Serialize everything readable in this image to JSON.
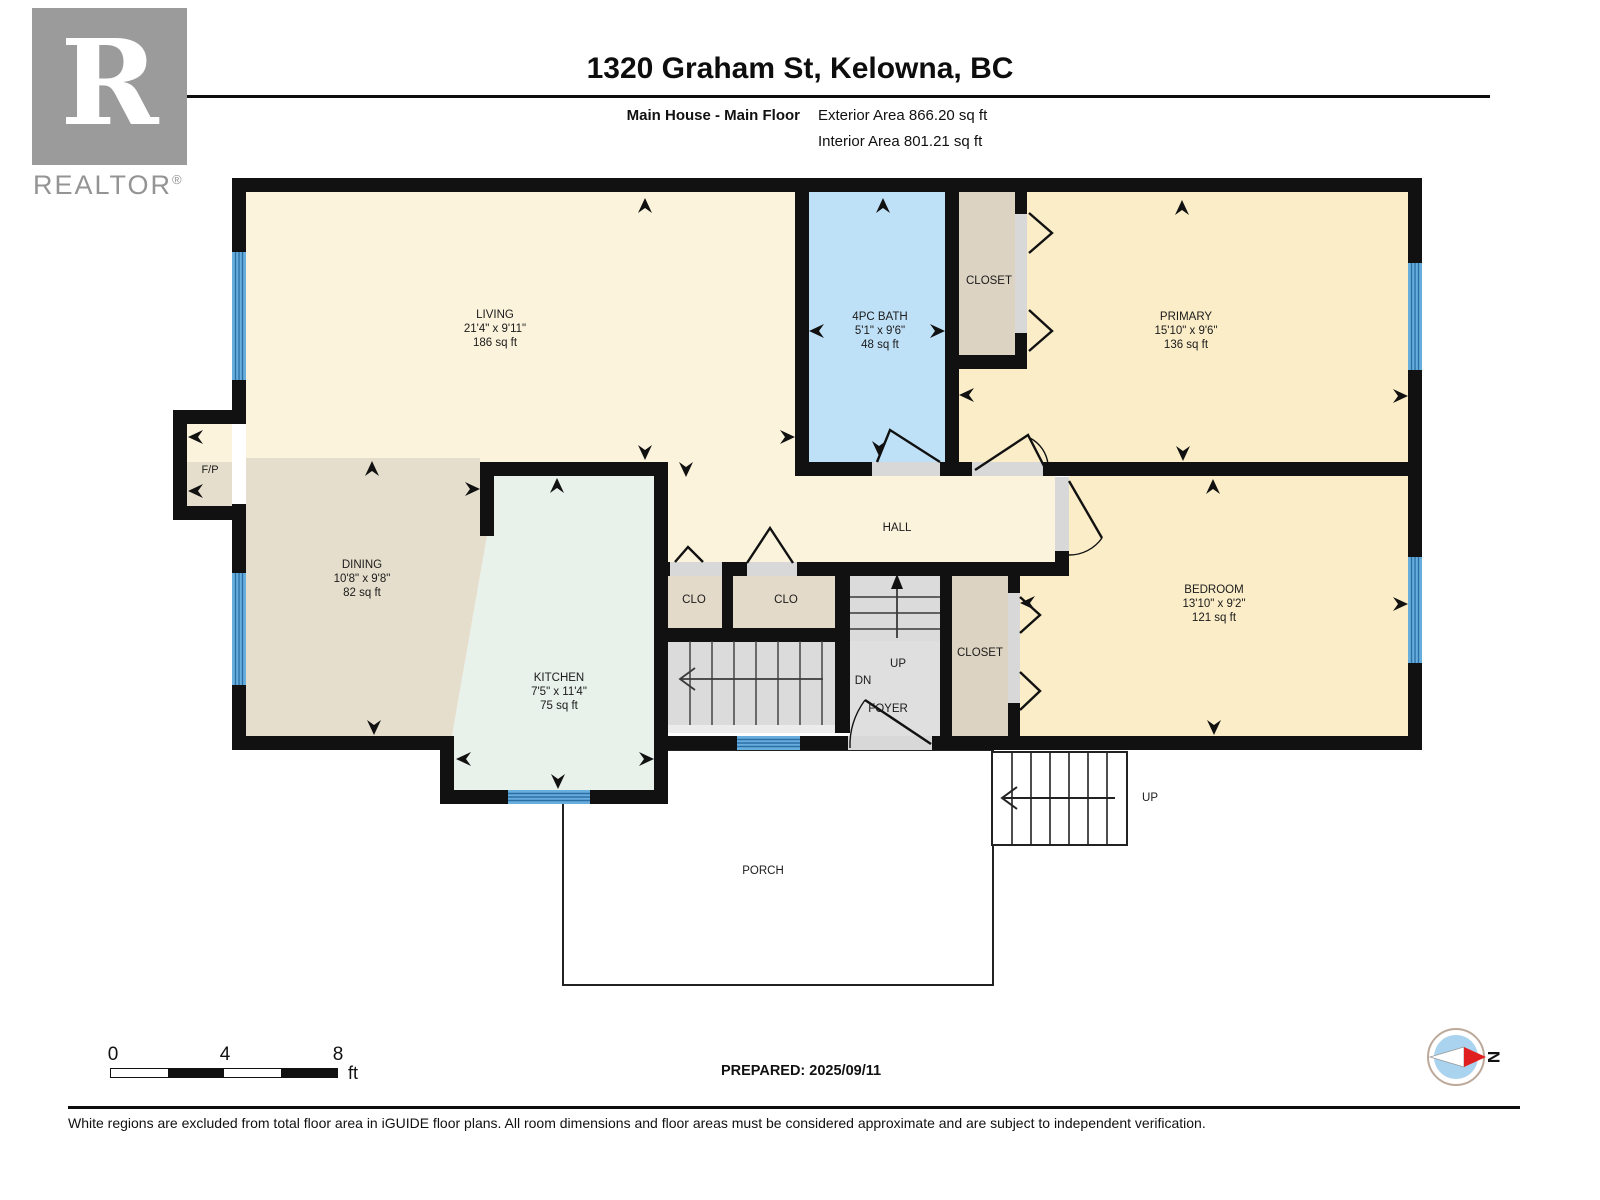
{
  "header": {
    "logo_letter": "R",
    "logo_label": "REALTOR",
    "logo_reg": "®",
    "title": "1320 Graham St, Kelowna, BC",
    "floor_label": "Main House - Main Floor",
    "exterior_area": "Exterior Area 866.20 sq ft",
    "interior_area": "Interior Area 801.21 sq ft"
  },
  "rooms": {
    "living": {
      "name": "LIVING",
      "dims": "21'4\" x 9'11\"",
      "area": "186 sq ft"
    },
    "bath": {
      "name": "4PC BATH",
      "dims": "5'1\" x 9'6\"",
      "area": "48 sq ft"
    },
    "closet_top": {
      "name": "CLOSET"
    },
    "primary": {
      "name": "PRIMARY",
      "dims": "15'10\" x 9'6\"",
      "area": "136 sq ft"
    },
    "fireplace": {
      "name": "F/P"
    },
    "dining": {
      "name": "DINING",
      "dims": "10'8\" x 9'8\"",
      "area": "82 sq ft"
    },
    "kitchen": {
      "name": "KITCHEN",
      "dims": "7'5\" x 11'4\"",
      "area": "75 sq ft"
    },
    "hall": {
      "name": "HALL"
    },
    "clo_left": {
      "name": "CLO"
    },
    "clo_right": {
      "name": "CLO"
    },
    "closet_bottom": {
      "name": "CLOSET"
    },
    "bedroom": {
      "name": "BEDROOM",
      "dims": "13'10\" x 9'2\"",
      "area": "121 sq ft"
    },
    "foyer": {
      "name": "FOYER"
    },
    "porch": {
      "name": "PORCH"
    }
  },
  "stairs": {
    "up_interior": "UP",
    "down_interior": "DN",
    "up_exterior": "UP"
  },
  "footer": {
    "scale": {
      "tick0": "0",
      "tick4": "4",
      "tick8": "8",
      "unit": "ft"
    },
    "prepared": "PREPARED: 2025/09/11",
    "compass_north": "N",
    "disclaimer": "White regions are excluded from total floor area in iGUIDE floor plans. All room dimensions and floor areas must be considered approximate and are subject to independent verification."
  },
  "colors": {
    "wall": "#111111",
    "living_hall": "#FBF3DC",
    "bedrooms": "#FAEDC8",
    "bath": "#BFE1F8",
    "closet": "#DDD3C2",
    "dining": "#E6DECC",
    "kitchen": "#E8F1EA",
    "stairs_gray": "#DBDBDB",
    "window_blue": "#5FA9DA",
    "compass_red": "#E02020"
  }
}
